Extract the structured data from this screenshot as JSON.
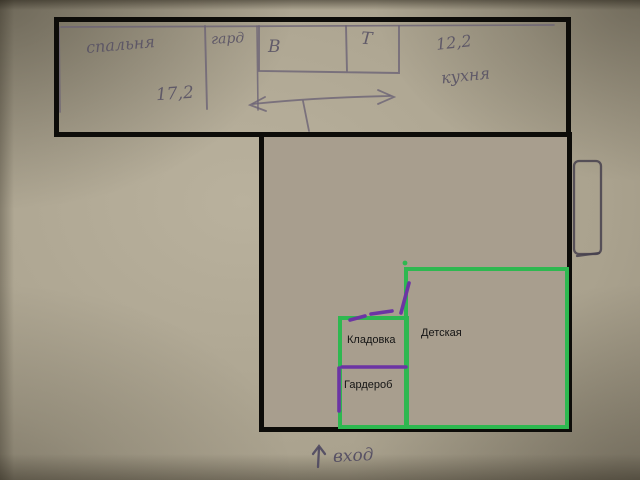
{
  "sketch": {
    "bedroom": {
      "label": "спальня",
      "area": "17,2"
    },
    "wardrobe_abbr": "гард",
    "bath": "В",
    "toilet": "Т",
    "kitchen": {
      "label": "кухня",
      "area": "12,2"
    },
    "entrance": {
      "arrow": "↑",
      "label": "вход"
    }
  },
  "paint_labels": {
    "storage": "Кладовка",
    "wardrobe": "Гардероб",
    "kids_room": "Детская"
  },
  "colors": {
    "paper": "#aaa28e",
    "flat_fill": "#a89e8e",
    "outline_black": "#0d0c09",
    "room_green": "#2eb850",
    "door_purple": "#6c34a4",
    "pencil": "#6b6375"
  }
}
